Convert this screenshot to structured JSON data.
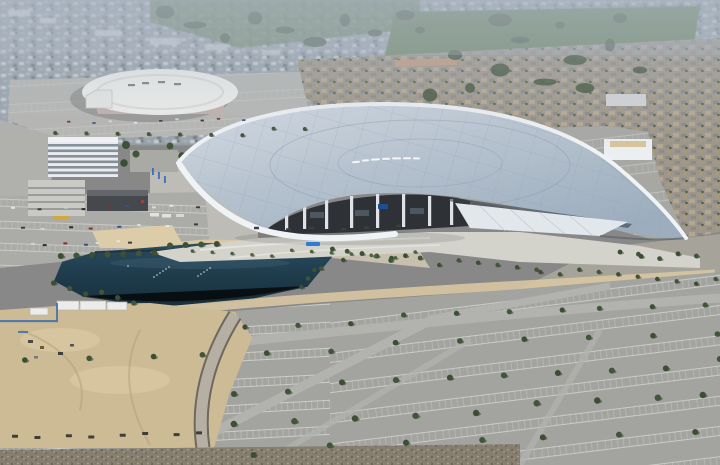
{
  "scene": {
    "description": "Aerial photograph of a large modern stadium with a sweeping silver roof beside a dark blue lake, surrounded by vast striped parking lots, a round white arena, office buildings, sandy construction ground and hazy residential neighborhoods stretching to the horizon",
    "roof_logo_mark": "illegible white script logo on stadium roof",
    "forum_roof_mark": "faint dark lettering on round arena roof"
  },
  "palette": {
    "city_base": "#99a2aa",
    "city_light": "#ccd2d7",
    "city_dark": "#6f7880",
    "park_green": "#5f7a4e",
    "park_dark": "#3c4f33",
    "tree_green": "#415539",
    "residential_base": "#9c968c",
    "roof_home_tan": "#b5a68e",
    "roof_home_gray": "#8b8781",
    "stadium_roof_light": "#d6dde5",
    "stadium_roof_mid": "#b7c3cf",
    "stadium_roof_deep": "#9cadbd",
    "stadium_rim": "#f0f3f6",
    "stadium_seam": "#8da0b4",
    "interior_dark": "#2e3237",
    "column_white": "#dfe3e7",
    "wedge_white": "#e2e7ec",
    "forum_white": "#efefec",
    "forum_base": "#c4b0aa",
    "lot_gray": "#a3a3a0",
    "lot_light": "#b6b6b2",
    "lot_line": "#e9e9e5",
    "road_light": "#b2b2ae",
    "lake_top": "#2a4c5e",
    "lake_mid": "#1f3c4c",
    "lake_deep": "#17303e",
    "path_tan": "#d8c7a2",
    "plaza_concrete": "#d3d2cb",
    "sand": "#cdbb95",
    "sand_light": "#dccca7",
    "office_white": "#e9ebee",
    "office_glass": "#73808c",
    "garage_gray": "#c9c9c6",
    "dark_building": "#45484d",
    "dark_roof": "#62656a",
    "red_accent": "#b03a2e",
    "blue_sign": "#2d7dd2",
    "blue_fence": "#3f6fae",
    "bus_yellow": "#d2a83c",
    "gravel_base": "#867e6f",
    "haze": "#aeb9c6"
  }
}
